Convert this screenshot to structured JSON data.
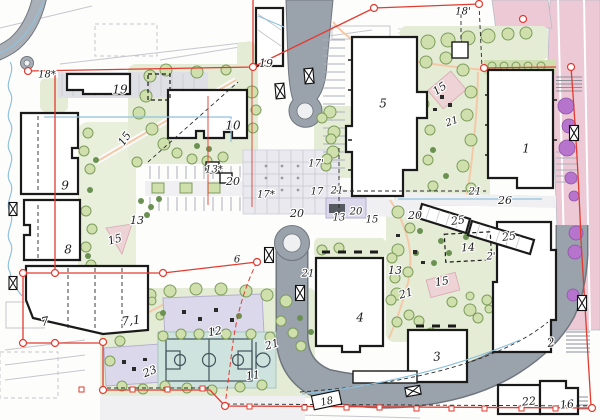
{
  "meta": {
    "kind": "architectural site master plan",
    "width": 600,
    "height": 420
  },
  "colors": {
    "road": "#9aa2ac",
    "road_edge": "#70767e",
    "road_inner": "#eef0f2",
    "pink_road": "#ecc9d4",
    "landscape": "#e4ecd5",
    "landscape_dark": "#cfdfb0",
    "tree_light": "#cfe0ad",
    "tree_edge": "#7d9c5c",
    "bush": "#6b9152",
    "tree_purple": "#b674cc",
    "court": "#cfe3de",
    "court_line": "#41535c",
    "playground": "#dcd8ec",
    "playground_edge": "#b5b0cf",
    "pink_patch": "#eed3d6",
    "boundary": "#e23b30",
    "water_blue": "#8fc1dc",
    "plaza": "#e9e9ef",
    "building_fill": "#ffffff",
    "building_edge": "#1a1a1a",
    "path_accent": "#f4c9a8",
    "faint": "#c6c6ce",
    "hatch": "#8a909a",
    "label_color": "#1c1c1c"
  },
  "labels": [
    {
      "t": "18*",
      "x": 47,
      "y": 75,
      "s": 10,
      "r": 0
    },
    {
      "t": "19",
      "x": 120,
      "y": 90,
      "s": 12,
      "r": 0
    },
    {
      "t": "19",
      "x": 266,
      "y": 64,
      "s": 11,
      "r": 0
    },
    {
      "t": "10",
      "x": 233,
      "y": 126,
      "s": 12,
      "r": 0
    },
    {
      "t": "5",
      "x": 383,
      "y": 104,
      "s": 12,
      "r": 0
    },
    {
      "t": "18'",
      "x": 463,
      "y": 12,
      "s": 10,
      "r": 0
    },
    {
      "t": "15",
      "x": 440,
      "y": 89,
      "s": 11,
      "r": -35
    },
    {
      "t": "21",
      "x": 452,
      "y": 122,
      "s": 10,
      "r": -20
    },
    {
      "t": "1",
      "x": 526,
      "y": 149,
      "s": 12,
      "r": 0
    },
    {
      "t": "9",
      "x": 65,
      "y": 186,
      "s": 12,
      "r": 0
    },
    {
      "t": "8",
      "x": 68,
      "y": 250,
      "s": 12,
      "r": 0
    },
    {
      "t": "13",
      "x": 137,
      "y": 221,
      "s": 11,
      "r": 0
    },
    {
      "t": "15",
      "x": 115,
      "y": 240,
      "s": 11,
      "r": -15
    },
    {
      "t": "15",
      "x": 125,
      "y": 139,
      "s": 11,
      "r": -55
    },
    {
      "t": "13*",
      "x": 214,
      "y": 170,
      "s": 10,
      "r": 0
    },
    {
      "t": "20",
      "x": 233,
      "y": 182,
      "s": 11,
      "r": 0
    },
    {
      "t": "17*",
      "x": 266,
      "y": 195,
      "s": 10,
      "r": 0
    },
    {
      "t": "17'",
      "x": 316,
      "y": 164,
      "s": 10,
      "r": 0
    },
    {
      "t": "17",
      "x": 317,
      "y": 192,
      "s": 10,
      "r": 0
    },
    {
      "t": "21",
      "x": 337,
      "y": 191,
      "s": 10,
      "r": 0
    },
    {
      "t": "20",
      "x": 297,
      "y": 214,
      "s": 11,
      "r": 0
    },
    {
      "t": "13",
      "x": 339,
      "y": 218,
      "s": 10,
      "r": 0
    },
    {
      "t": "20",
      "x": 356,
      "y": 212,
      "s": 10,
      "r": 0
    },
    {
      "t": "15",
      "x": 372,
      "y": 220,
      "s": 10,
      "r": 0
    },
    {
      "t": "6",
      "x": 237,
      "y": 260,
      "s": 10,
      "r": 0
    },
    {
      "t": "21",
      "x": 308,
      "y": 274,
      "s": 10,
      "r": 0
    },
    {
      "t": "20",
      "x": 415,
      "y": 216,
      "s": 11,
      "r": 0
    },
    {
      "t": "21",
      "x": 475,
      "y": 192,
      "s": 10,
      "r": 0
    },
    {
      "t": "26",
      "x": 505,
      "y": 201,
      "s": 11,
      "r": 0
    },
    {
      "t": "25",
      "x": 458,
      "y": 221,
      "s": 11,
      "r": -8
    },
    {
      "t": "25",
      "x": 509,
      "y": 237,
      "s": 11,
      "r": -8
    },
    {
      "t": "14",
      "x": 468,
      "y": 248,
      "s": 11,
      "r": -4
    },
    {
      "t": "2'",
      "x": 491,
      "y": 257,
      "s": 10,
      "r": 0
    },
    {
      "t": "13",
      "x": 395,
      "y": 271,
      "s": 11,
      "r": 0
    },
    {
      "t": "15",
      "x": 442,
      "y": 282,
      "s": 11,
      "r": -10
    },
    {
      "t": "21",
      "x": 406,
      "y": 294,
      "s": 11,
      "r": -15
    },
    {
      "t": "7",
      "x": 45,
      "y": 322,
      "s": 12,
      "r": -10
    },
    {
      "t": "7,1",
      "x": 131,
      "y": 321,
      "s": 12,
      "r": -6
    },
    {
      "t": "23",
      "x": 150,
      "y": 372,
      "s": 11,
      "r": -22
    },
    {
      "t": "12",
      "x": 215,
      "y": 332,
      "s": 11,
      "r": -10
    },
    {
      "t": "11",
      "x": 253,
      "y": 376,
      "s": 11,
      "r": -8
    },
    {
      "t": "21",
      "x": 272,
      "y": 345,
      "s": 11,
      "r": -15
    },
    {
      "t": "4",
      "x": 360,
      "y": 318,
      "s": 12,
      "r": 0
    },
    {
      "t": "3",
      "x": 437,
      "y": 357,
      "s": 12,
      "r": -5
    },
    {
      "t": "2",
      "x": 551,
      "y": 343,
      "s": 12,
      "r": -8
    },
    {
      "t": "22",
      "x": 529,
      "y": 402,
      "s": 11,
      "r": -5
    },
    {
      "t": "16",
      "x": 567,
      "y": 405,
      "s": 11,
      "r": -5
    },
    {
      "t": "18",
      "x": 327,
      "y": 402,
      "s": 10,
      "r": -12,
      "box": true
    }
  ]
}
